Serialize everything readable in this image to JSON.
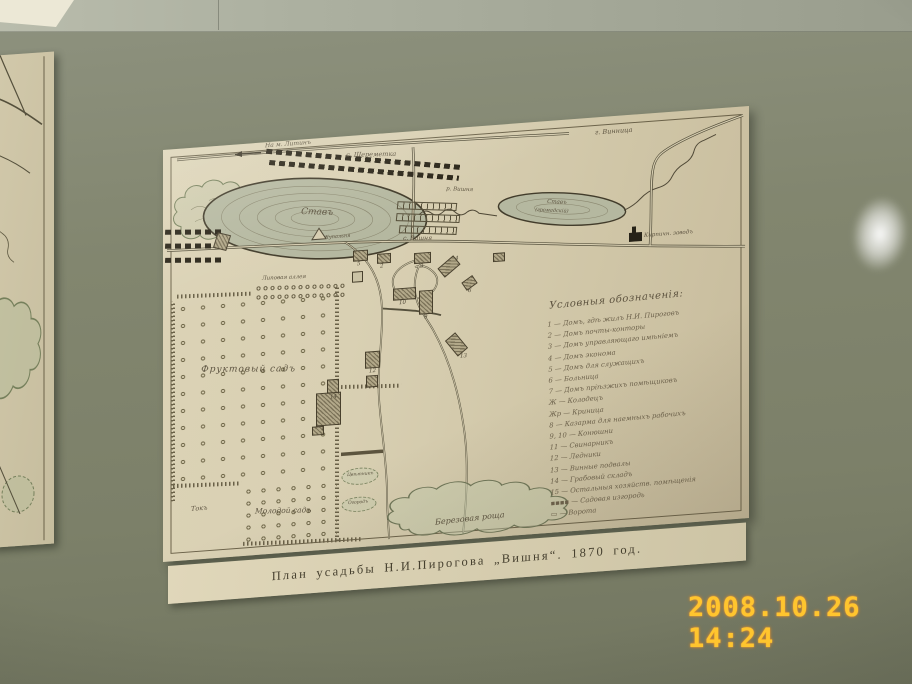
{
  "photo": {
    "camera_timestamp": "2008.10.26 14:24"
  },
  "caption_strip": {
    "text": "План усадьбы Н.И.Пирогова „Вишня“. 1870 год."
  },
  "map": {
    "roads": {
      "to_litin": "На м. Литинъ",
      "to_vinnitsa": "г. Винница"
    },
    "settlements": {
      "sheremetka": "с. Шереметка",
      "vishnya": "с. Вишня"
    },
    "water": {
      "estate_pond": "Ставъ",
      "village_pond_line1": "Ставъ",
      "village_pond_line2": "(громадскій)",
      "river": "р. Вишня",
      "bathing": "Купальня"
    },
    "features": {
      "orchard": "Фруктовый садъ",
      "young_orchard": "Молодой садъ",
      "linden_alley": "Липовая аллея",
      "birch_grove": "Березовая роща",
      "brick_factory": "Кирпичн. заводъ",
      "threshing_floor": "Токъ",
      "flower_garden": "Цвѣтникъ",
      "kitchen_garden": "Огородъ"
    },
    "numbers": [
      "1",
      "2",
      "3",
      "4",
      "5",
      "6",
      "9",
      "10",
      "12",
      "13",
      "14"
    ],
    "legend": {
      "title": "Условныя обозначенія:",
      "items": [
        "1 — Домъ, гдѣ жилъ Н.И. Пироговъ",
        "2 — Домъ почты-конторы",
        "3 — Домъ управляющаго имѣніемъ",
        "4 — Домъ эконома",
        "5 — Домъ для служащихъ",
        "6 — Больница",
        "7 — Домъ пріѣзжихъ помѣщиковъ",
        "Ж — Колодецъ",
        "Жр — Криница",
        "8 — Казарма для наемныхъ рабочихъ",
        "9, 10 — Конюшни",
        "11 — Свинарникъ",
        "12 — Ледники",
        "13 — Винные подвалы",
        "14 — Грабовый складъ",
        "15 — Остальныя хозяйств. помѣщенія",
        "▪▪▪▪ — Садовая изгородь",
        "▭ — Ворота"
      ]
    }
  }
}
